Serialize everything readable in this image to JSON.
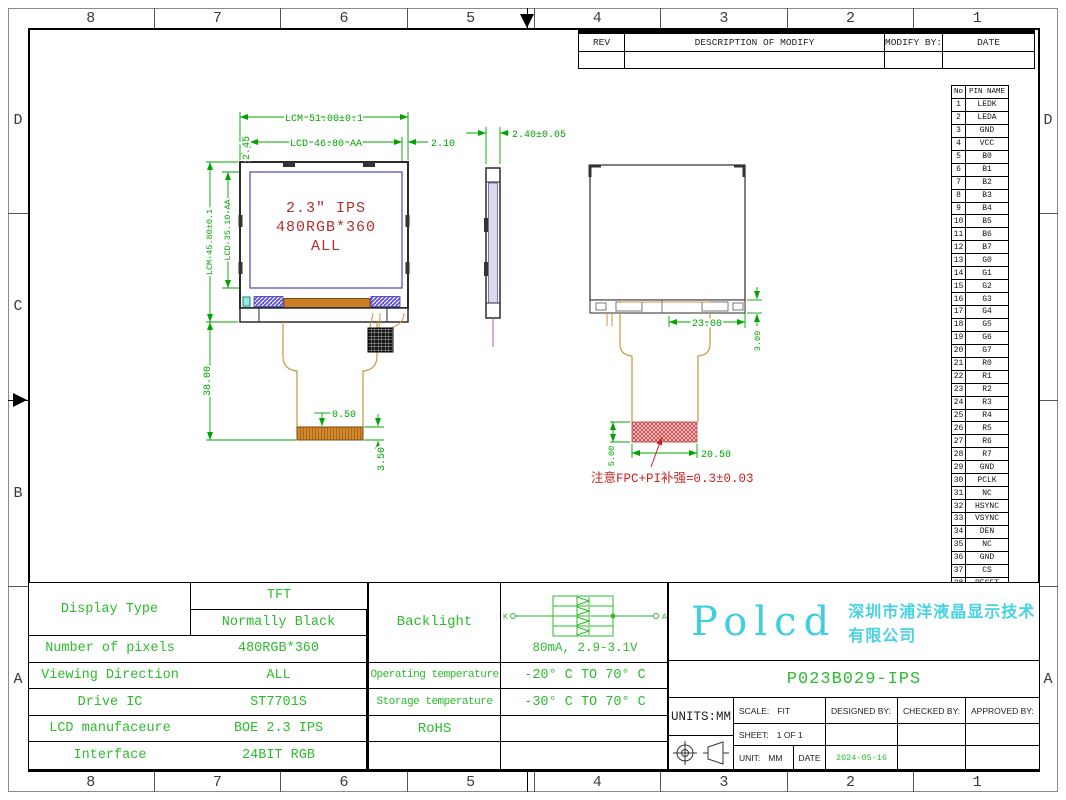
{
  "sheet": {
    "border_columns": [
      "8",
      "7",
      "6",
      "5",
      "4",
      "3",
      "2",
      "1"
    ],
    "border_rows_left": [
      "D",
      "C",
      "B",
      "A"
    ],
    "border_rows_right": [
      "D",
      "",
      "",
      "A"
    ]
  },
  "rev_table": {
    "headers": [
      "REV",
      "DESCRIPTION OF MODIFY",
      "MODIFY BY:",
      "DATE"
    ]
  },
  "pin_table": {
    "headers": [
      "No",
      "PIN NAME"
    ],
    "pins": [
      {
        "no": "1",
        "name": "LEDK"
      },
      {
        "no": "2",
        "name": "LEDA"
      },
      {
        "no": "3",
        "name": "GND"
      },
      {
        "no": "4",
        "name": "VCC"
      },
      {
        "no": "5",
        "name": "B0"
      },
      {
        "no": "6",
        "name": "B1"
      },
      {
        "no": "7",
        "name": "B2"
      },
      {
        "no": "8",
        "name": "B3"
      },
      {
        "no": "9",
        "name": "B4"
      },
      {
        "no": "10",
        "name": "B5"
      },
      {
        "no": "11",
        "name": "B6"
      },
      {
        "no": "12",
        "name": "B7"
      },
      {
        "no": "13",
        "name": "G0"
      },
      {
        "no": "14",
        "name": "G1"
      },
      {
        "no": "15",
        "name": "G2"
      },
      {
        "no": "16",
        "name": "G3"
      },
      {
        "no": "17",
        "name": "G4"
      },
      {
        "no": "18",
        "name": "G5"
      },
      {
        "no": "19",
        "name": "G6"
      },
      {
        "no": "20",
        "name": "G7"
      },
      {
        "no": "21",
        "name": "R0"
      },
      {
        "no": "22",
        "name": "R1"
      },
      {
        "no": "23",
        "name": "R2"
      },
      {
        "no": "24",
        "name": "R3"
      },
      {
        "no": "25",
        "name": "R4"
      },
      {
        "no": "26",
        "name": "R5"
      },
      {
        "no": "27",
        "name": "R6"
      },
      {
        "no": "28",
        "name": "R7"
      },
      {
        "no": "29",
        "name": "GND"
      },
      {
        "no": "30",
        "name": "PCLK"
      },
      {
        "no": "31",
        "name": "NC"
      },
      {
        "no": "32",
        "name": "HSYNC"
      },
      {
        "no": "33",
        "name": "VSYNC"
      },
      {
        "no": "34",
        "name": "DEN"
      },
      {
        "no": "35",
        "name": "NC"
      },
      {
        "no": "36",
        "name": "GND"
      },
      {
        "no": "37",
        "name": "CS"
      },
      {
        "no": "38",
        "name": "RESET"
      },
      {
        "no": "39",
        "name": "SCL"
      },
      {
        "no": "40",
        "name": "SDA"
      }
    ]
  },
  "front_view": {
    "label_line1": "2.3″ IPS",
    "label_line2": "480RGB*360",
    "label_line3": "ALL",
    "dim_lcm_width": "LCM 51.00±0.1",
    "dim_lcd_width": "LCD 46.80 AA",
    "dim_right_margin": "2.10",
    "dim_top_margin": "2.45",
    "dim_lcm_height": "LCM 45.80±0.1",
    "dim_lcd_height": "LCD 35.10 AA",
    "dim_fpc_length": "38.00",
    "dim_pitch": "0.50",
    "dim_tail": "3.50"
  },
  "side_view": {
    "dim_thickness": "2.40±0.05"
  },
  "back_view": {
    "dim_conn_width": "23.00",
    "dim_conn_height": "3.09",
    "dim_stiffener_height": "5.00",
    "dim_stiffener_width": "20.50",
    "note": "注意FPC+PI补强=0.3±0.03"
  },
  "spec_table": {
    "display_type_label": "Display Type",
    "display_type_value1": "TFT",
    "display_type_value2": "Normally Black",
    "rows": [
      {
        "label": "Number of pixels",
        "value": "480RGB*360"
      },
      {
        "label": "Viewing Direction",
        "value": "ALL"
      },
      {
        "label": "Drive IC",
        "value": "ST7701S"
      },
      {
        "label": "LCD manufaceure",
        "value": "BOE 2.3 IPS"
      },
      {
        "label": "Interface",
        "value": "24BIT RGB"
      }
    ]
  },
  "env_table": {
    "backlight_label": "Backlight",
    "backlight_current": "80mA, 2.9-3.1V",
    "led_k": "K",
    "led_a": "A",
    "rows": [
      {
        "label": "Operating temperature",
        "value": "-20° C TO 70° C"
      },
      {
        "label": "Storage temperature",
        "value": "-30° C TO 70° C"
      },
      {
        "label": "RoHS",
        "value": ""
      }
    ]
  },
  "title_block": {
    "logo": "Polcd",
    "company": "深圳市浦洋液晶显示技术有限公司",
    "part_number": "P023B029-IPS",
    "units": "UNITS:MM",
    "scale_label": "SCALE:",
    "scale_value": "FIT",
    "designed_by": "DESIGNED BY:",
    "checked_by": "CHECKED BY:",
    "approved_by": "APPROVED BY:",
    "sheet_label": "SHEET:",
    "sheet_value": "1 OF 1",
    "unit_label": "UNIT:",
    "unit_value": "MM",
    "date_label": "DATE",
    "date_value": "2024-05-16"
  },
  "colors": {
    "dimension_green": "#00a300",
    "table_green": "#2dbb2d",
    "annotation_red": "#b03030",
    "note_red": "#cc2222",
    "brand_cyan": "#3fcfe0",
    "fpc_tan": "#c8963c",
    "bonding_orange": "#cd7f27"
  }
}
